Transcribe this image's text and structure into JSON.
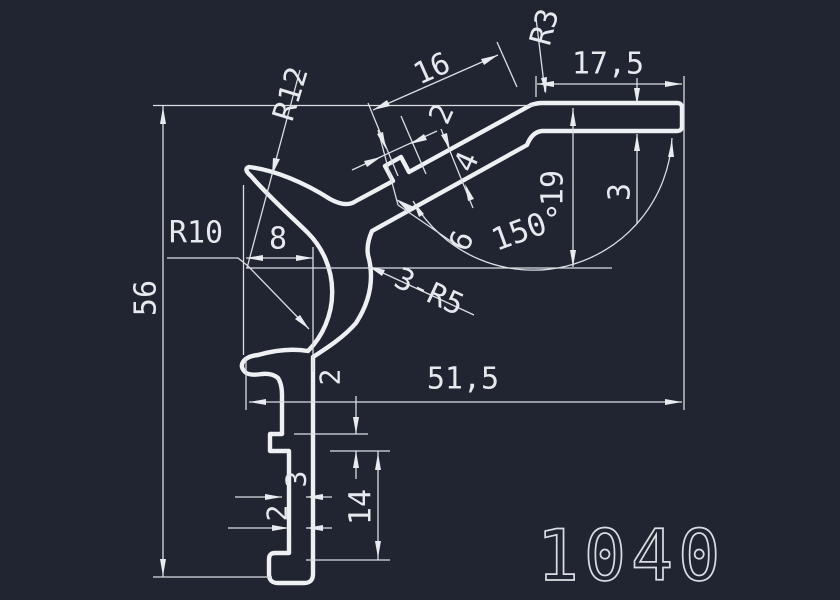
{
  "drawing": {
    "number": "1040",
    "background_color": "#202531",
    "profile_color": "#eef0f3",
    "dimension_color": "#d9dde3",
    "type": "extrusion-profile-cross-section"
  },
  "labels": [
    {
      "name": "dim-56",
      "text": "56",
      "x": 146,
      "y": 298,
      "rot": -90,
      "size": 30,
      "style": "solid"
    },
    {
      "name": "radius-r12",
      "text": "R12",
      "x": 291,
      "y": 94,
      "rot": -73,
      "size": 30,
      "style": "solid"
    },
    {
      "name": "radius-r10",
      "text": "R10",
      "x": 196,
      "y": 233,
      "rot": 0,
      "size": 30,
      "style": "solid"
    },
    {
      "name": "dim-8",
      "text": "8",
      "x": 278,
      "y": 239,
      "rot": 0,
      "size": 30,
      "style": "solid"
    },
    {
      "name": "dim-16",
      "text": "16",
      "x": 432,
      "y": 69,
      "rot": -24,
      "size": 30,
      "style": "solid"
    },
    {
      "name": "dim-2-bump",
      "text": "2",
      "x": 442,
      "y": 114,
      "rot": -66,
      "size": 30,
      "style": "solid"
    },
    {
      "name": "radius-r3",
      "text": "R3",
      "x": 545,
      "y": 27,
      "rot": -75,
      "size": 30,
      "style": "solid"
    },
    {
      "name": "dim-17-5",
      "text": "17,5",
      "x": 608,
      "y": 64,
      "rot": 0,
      "size": 30,
      "style": "solid"
    },
    {
      "name": "dim-4",
      "text": "4",
      "x": 467,
      "y": 162,
      "rot": -66,
      "size": 30,
      "style": "solid"
    },
    {
      "name": "dim-19",
      "text": "19",
      "x": 553,
      "y": 188,
      "rot": -90,
      "size": 30,
      "style": "solid"
    },
    {
      "name": "dim-3-flange",
      "text": "3",
      "x": 620,
      "y": 192,
      "rot": -90,
      "size": 30,
      "style": "solid"
    },
    {
      "name": "angle-150",
      "text": "150°",
      "x": 528,
      "y": 229,
      "rot": -20,
      "size": 31,
      "style": "solid"
    },
    {
      "name": "dim-6",
      "text": "6",
      "x": 462,
      "y": 241,
      "rot": -66,
      "size": 30,
      "style": "solid"
    },
    {
      "name": "fillet-3-r5",
      "text": "3-R5",
      "x": 429,
      "y": 292,
      "rot": 25,
      "size": 30,
      "style": "solid"
    },
    {
      "name": "dim-2-tab",
      "text": "2",
      "x": 330,
      "y": 377,
      "rot": -90,
      "size": 28,
      "style": "solid"
    },
    {
      "name": "dim-51-5",
      "text": "51,5",
      "x": 463,
      "y": 379,
      "rot": 0,
      "size": 30,
      "style": "solid"
    },
    {
      "name": "dim-3-stem",
      "text": "3",
      "x": 296,
      "y": 479,
      "rot": -90,
      "size": 28,
      "style": "solid"
    },
    {
      "name": "dim-2-stem",
      "text": "2",
      "x": 277,
      "y": 513,
      "rot": -90,
      "size": 28,
      "style": "solid"
    },
    {
      "name": "dim-14",
      "text": "14",
      "x": 361,
      "y": 507,
      "rot": -90,
      "size": 30,
      "style": "solid"
    },
    {
      "name": "drawing-number",
      "text": "1040",
      "x": 631,
      "y": 556,
      "rot": 0,
      "size": 70,
      "style": "outline"
    }
  ]
}
